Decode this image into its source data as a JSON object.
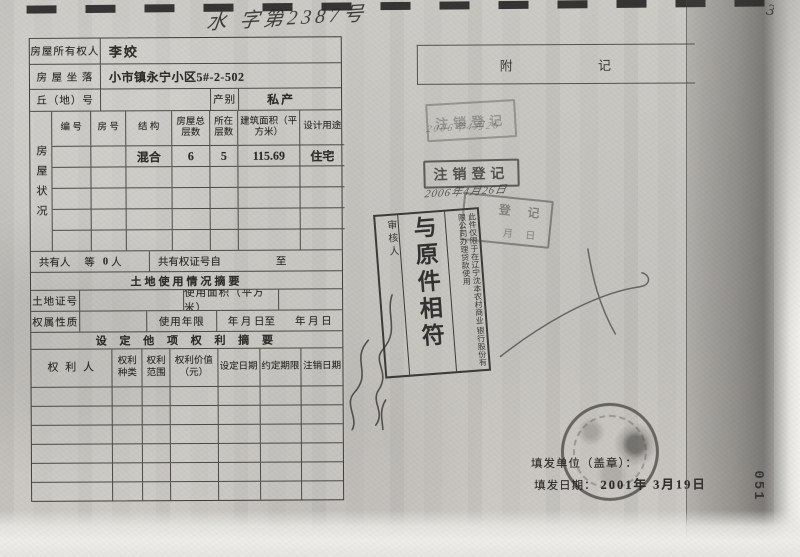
{
  "page": {
    "header": {
      "handwritten_number": "水 字第2387号",
      "corner_mark": "3"
    },
    "main_table": {
      "owner": {
        "label": "房屋所有权人",
        "value": "李姣"
      },
      "location": {
        "label": "房 屋 坐 落",
        "value": "小市镇永宁小区5#-2-502"
      },
      "plot": {
        "label": "丘（地）号",
        "category_label": "产别",
        "category_value": "私产"
      },
      "status": {
        "side_label": "房屋状况",
        "columns": [
          "编 号",
          "房 号",
          "结 构",
          "房屋总层数",
          "所在层数",
          "建筑面积（平方米）",
          "设计用途"
        ],
        "row1": {
          "structure": "混合",
          "total_floors": "6",
          "floor": "5",
          "area": "115.69",
          "use": "住宅"
        }
      },
      "co_owner": {
        "label": "共有人",
        "prefix": "等",
        "count": "0",
        "suffix": "人",
        "cert_from": "共有权证号自",
        "cert_to": "至"
      },
      "land_section_title": "土地使用情况摘要",
      "land_cert": {
        "label": "土地证号",
        "area_label": "使用面积（平方米）"
      },
      "tenure": {
        "label": "权属性质",
        "term_label": "使用年限",
        "term_from": "年 月 日至",
        "term_to": "年 月 日"
      },
      "rights_section_title": "设 定 他 项 权 利 摘 要",
      "rights": {
        "columns": [
          "权 利 人",
          "权利种类",
          "权利范围",
          "权利价值（元）",
          "设定日期",
          "约定期限",
          "注销日期"
        ]
      }
    },
    "notes": {
      "title": "附 记"
    },
    "stamps": {
      "cancel1": {
        "text": "注销登记",
        "handwriting": "2006年4月26"
      },
      "cancel2": {
        "text": "注销登记",
        "handwriting": "2006年4月26日"
      },
      "partial": {
        "line1": "登 记",
        "line2": "月 日"
      },
      "copy": {
        "reviewer_label": "审核人",
        "main_text": "与原件相符",
        "note_col1": "此件仅限于在辽宁沈本农村商业",
        "note_col2": "银行股份有限公司办理贷款使用"
      }
    },
    "footer": {
      "issue_unit_label": "填发单位（盖章）：",
      "issue_date_label": "填发日期：",
      "issue_date_value": "2001年 3月19日",
      "page_number": "051"
    }
  }
}
